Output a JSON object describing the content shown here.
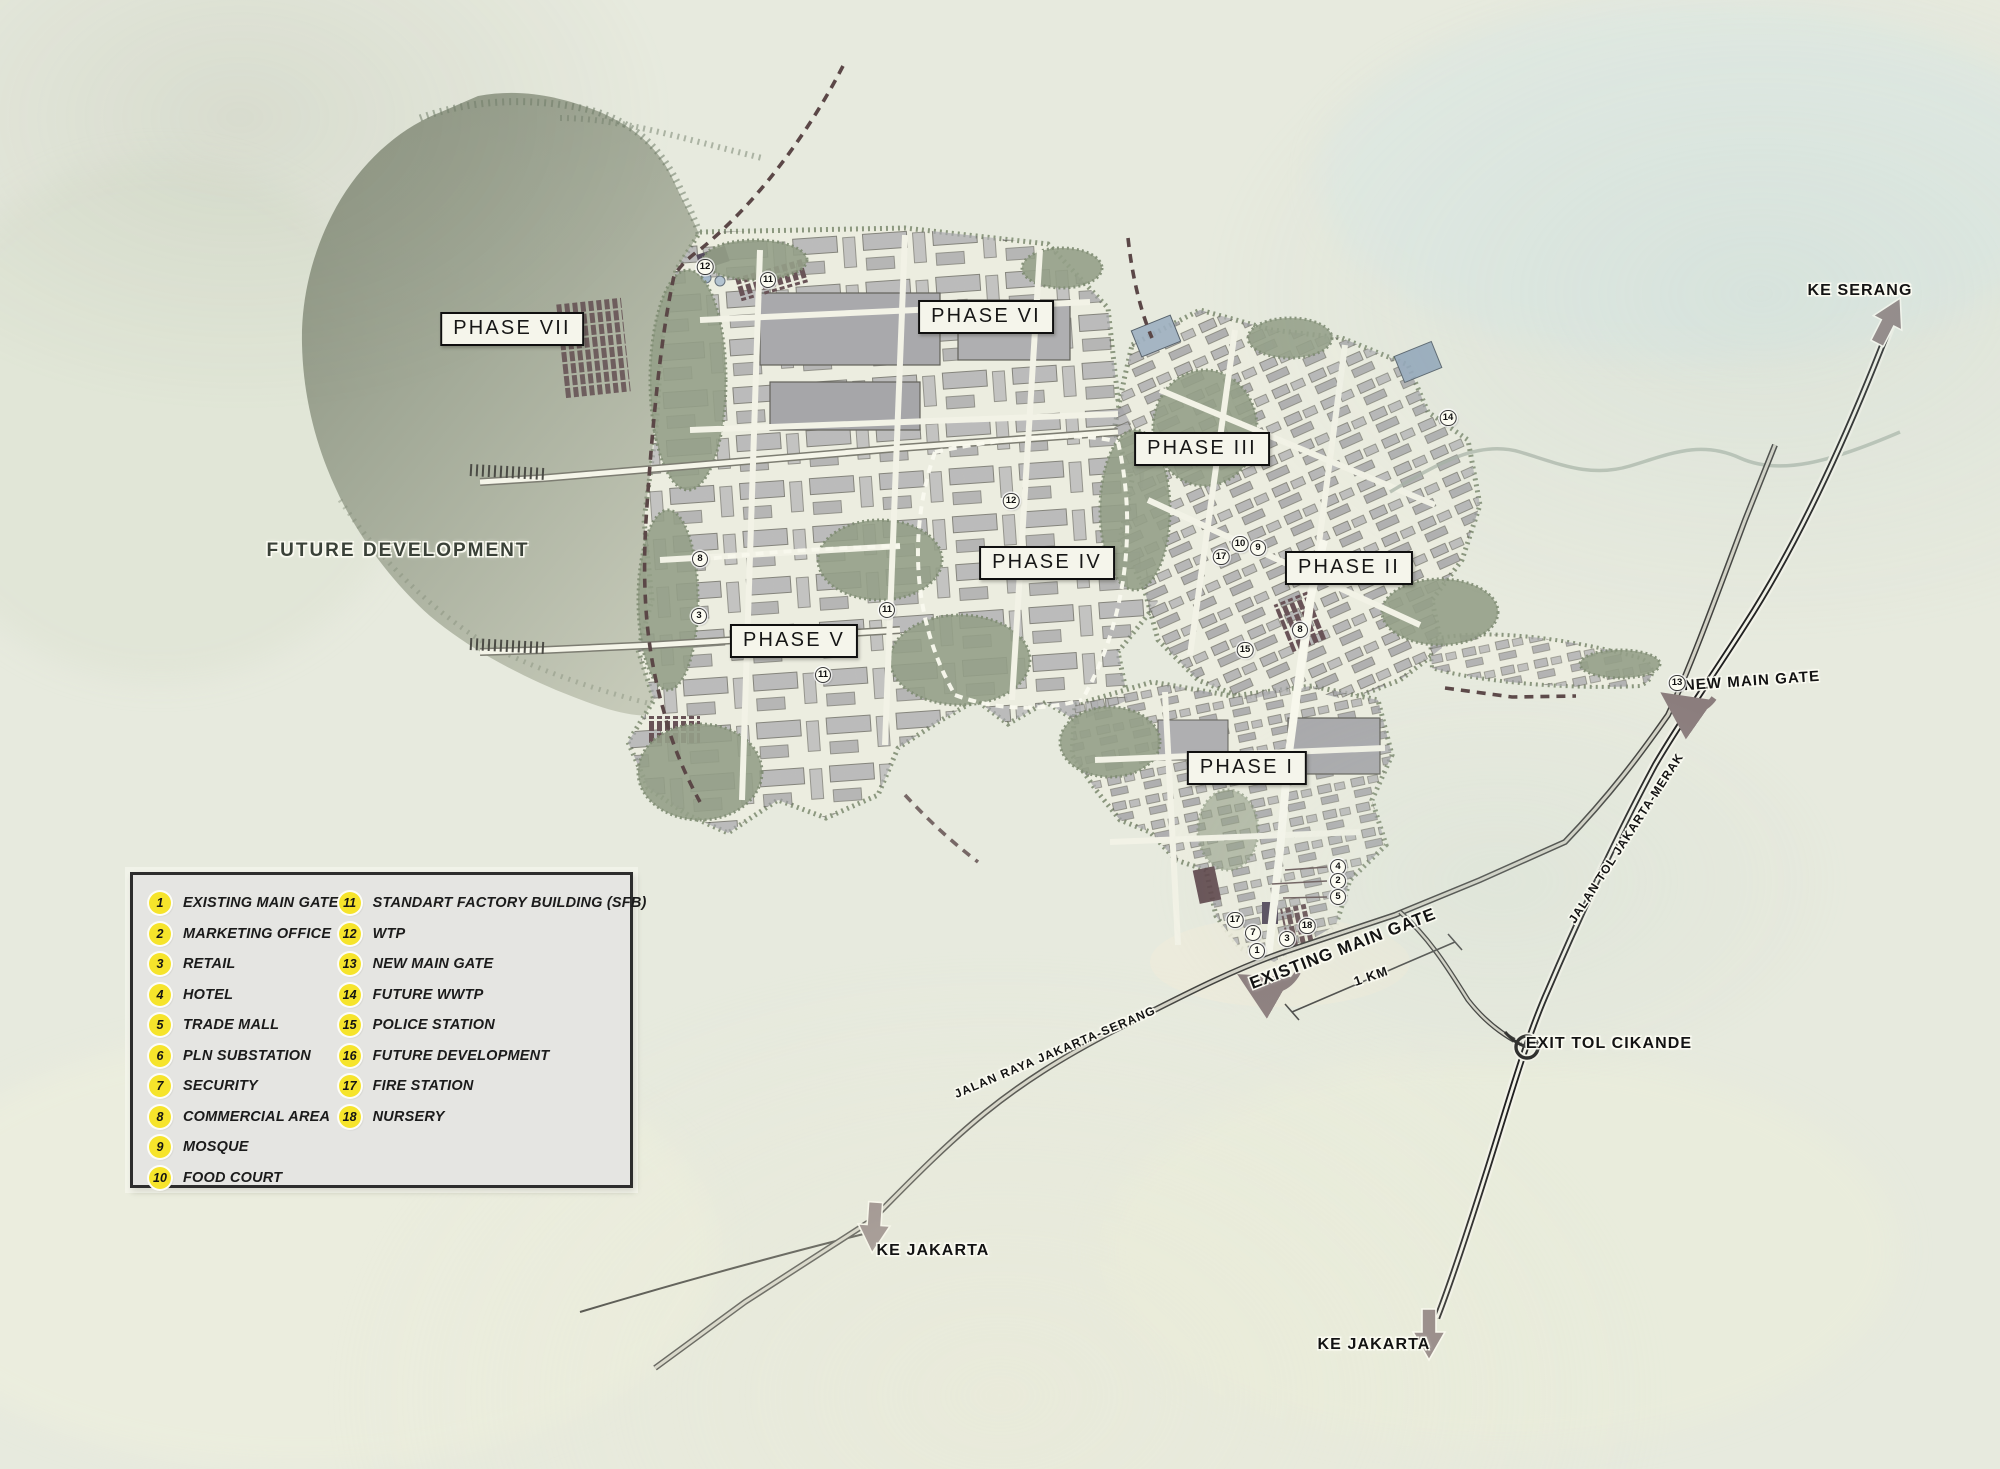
{
  "map_title": "Industrial estate masterplan",
  "colors": {
    "background": "#e7eade",
    "lake_dark": "#8f9684",
    "lake_light": "#c3c8b7",
    "estate": "#ecede0",
    "buildings_gray": "#a6a6aa",
    "trees_green": "#95a088",
    "sfb_maroon": "#5d454b",
    "boundary_dash": "#5b4747",
    "toll_road": "#1f1f1f",
    "arrow_taupe": "#8b7d7d",
    "legend_bg": "#e5e5e2",
    "legend_badge": "#f6e42b"
  },
  "legend": {
    "items": [
      {
        "num": "1",
        "label": "EXISTING MAIN GATE"
      },
      {
        "num": "2",
        "label": "MARKETING OFFICE"
      },
      {
        "num": "3",
        "label": "RETAIL"
      },
      {
        "num": "4",
        "label": "HOTEL"
      },
      {
        "num": "5",
        "label": "TRADE MALL"
      },
      {
        "num": "6",
        "label": "PLN SUBSTATION"
      },
      {
        "num": "7",
        "label": "SECURITY"
      },
      {
        "num": "8",
        "label": "COMMERCIAL AREA"
      },
      {
        "num": "9",
        "label": "MOSQUE"
      },
      {
        "num": "10",
        "label": "FOOD COURT"
      },
      {
        "num": "11",
        "label": "STANDART FACTORY BUILDING (SFB)"
      },
      {
        "num": "12",
        "label": "WTP"
      },
      {
        "num": "13",
        "label": "NEW MAIN GATE"
      },
      {
        "num": "14",
        "label": "FUTURE WWTP"
      },
      {
        "num": "15",
        "label": "POLICE STATION"
      },
      {
        "num": "16",
        "label": "FUTURE DEVELOPMENT"
      },
      {
        "num": "17",
        "label": "FIRE STATION"
      },
      {
        "num": "18",
        "label": "NURSERY"
      }
    ]
  },
  "phase_labels": [
    {
      "id": "phase-vii",
      "label": "PHASE VII",
      "cx": 512,
      "cy": 329
    },
    {
      "id": "phase-vi",
      "label": "PHASE VI",
      "cx": 986,
      "cy": 317
    },
    {
      "id": "phase-iii",
      "label": "PHASE III",
      "cx": 1202,
      "cy": 449
    },
    {
      "id": "phase-iv",
      "label": "PHASE IV",
      "cx": 1047,
      "cy": 563
    },
    {
      "id": "phase-ii",
      "label": "PHASE II",
      "cx": 1349,
      "cy": 568
    },
    {
      "id": "phase-v",
      "label": "PHASE V",
      "cx": 794,
      "cy": 641
    },
    {
      "id": "phase-i",
      "label": "PHASE I",
      "cx": 1247,
      "cy": 768
    }
  ],
  "map_labels": [
    {
      "id": "future-development",
      "text": "FUTURE DEVELOPMENT",
      "cx": 398,
      "cy": 551,
      "rot": 0,
      "fs": 19,
      "cls": "muted"
    },
    {
      "id": "ke-serang",
      "text": "KE SERANG",
      "cx": 1860,
      "cy": 291,
      "rot": 0,
      "fs": 16,
      "cls": ""
    },
    {
      "id": "new-main-gate",
      "text": "NEW MAIN GATE",
      "cx": 1752,
      "cy": 681,
      "rot": -4,
      "fs": 15,
      "cls": ""
    },
    {
      "id": "existing-main-gate",
      "text": "EXISTING MAIN GATE",
      "cx": 1343,
      "cy": 949,
      "rot": -21,
      "fs": 17,
      "cls": ""
    },
    {
      "id": "scale-1km",
      "text": "1 KM",
      "cx": 1371,
      "cy": 976,
      "rot": -19,
      "fs": 13,
      "cls": ""
    },
    {
      "id": "exit-tol-cikande",
      "text": "EXIT TOL CIKANDE",
      "cx": 1609,
      "cy": 1044,
      "rot": 0,
      "fs": 16,
      "cls": ""
    },
    {
      "id": "ke-jakarta-southwest",
      "text": "KE JAKARTA",
      "cx": 933,
      "cy": 1251,
      "rot": 0,
      "fs": 16,
      "cls": ""
    },
    {
      "id": "ke-jakarta-southeast",
      "text": "KE JAKARTA",
      "cx": 1374,
      "cy": 1345,
      "rot": 0,
      "fs": 16,
      "cls": ""
    },
    {
      "id": "jalan-raya-jakarta-serang",
      "text": "JALAN RAYA JAKARTA-SERANG",
      "cx": 1055,
      "cy": 1052,
      "rot": -23,
      "fs": 12,
      "cls": ""
    },
    {
      "id": "jalan-tol-jakarta-merak",
      "text": "JALAN TOL JAKARTA-MERAK",
      "cx": 1626,
      "cy": 838,
      "rot": -57,
      "fs": 12,
      "cls": ""
    }
  ],
  "markers": [
    {
      "n": "12",
      "x": 705,
      "y": 267
    },
    {
      "n": "11",
      "x": 768,
      "y": 280
    },
    {
      "n": "8",
      "x": 700,
      "y": 559
    },
    {
      "n": "3",
      "x": 699,
      "y": 616
    },
    {
      "n": "11",
      "x": 887,
      "y": 610
    },
    {
      "n": "11",
      "x": 823,
      "y": 675
    },
    {
      "n": "12",
      "x": 1011,
      "y": 501
    },
    {
      "n": "14",
      "x": 1448,
      "y": 418
    },
    {
      "n": "15",
      "x": 1245,
      "y": 650
    },
    {
      "n": "8",
      "x": 1300,
      "y": 630
    },
    {
      "n": "17",
      "x": 1221,
      "y": 557
    },
    {
      "n": "10",
      "x": 1240,
      "y": 544
    },
    {
      "n": "9",
      "x": 1258,
      "y": 548
    },
    {
      "n": "13",
      "x": 1677,
      "y": 683
    },
    {
      "n": "4",
      "x": 1338,
      "y": 867
    },
    {
      "n": "2",
      "x": 1338,
      "y": 881
    },
    {
      "n": "5",
      "x": 1338,
      "y": 897
    },
    {
      "n": "18",
      "x": 1307,
      "y": 926
    },
    {
      "n": "3",
      "x": 1287,
      "y": 939
    },
    {
      "n": "7",
      "x": 1253,
      "y": 933
    },
    {
      "n": "17",
      "x": 1235,
      "y": 920
    },
    {
      "n": "1",
      "x": 1257,
      "y": 951
    }
  ]
}
